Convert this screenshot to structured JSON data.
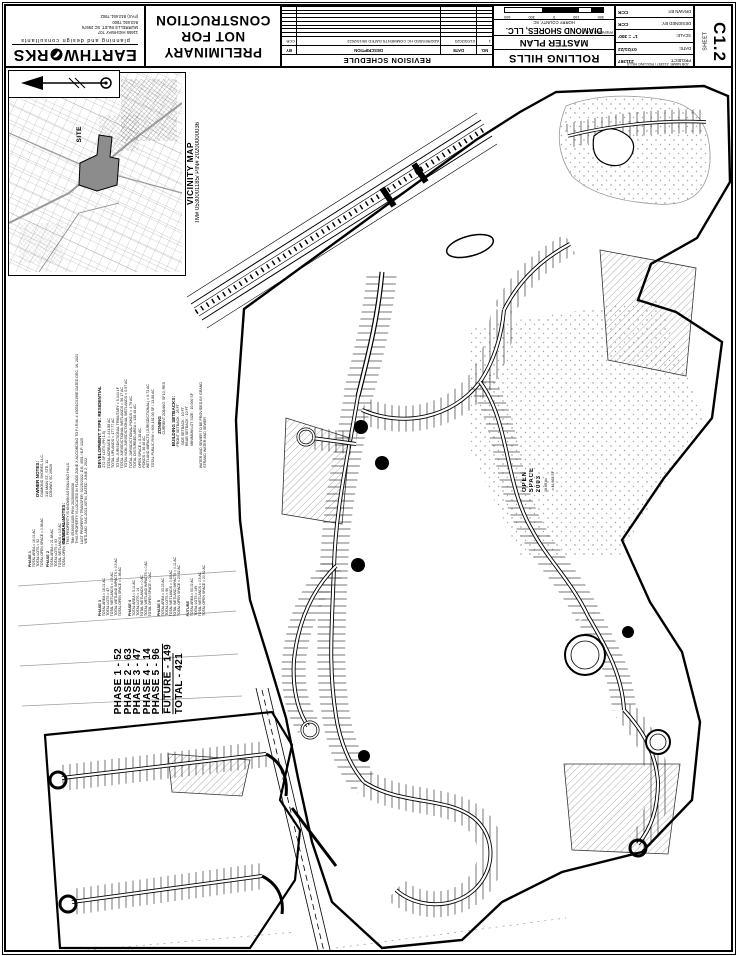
{
  "title_block": {
    "logo": {
      "name_left": "EARTHW",
      "name_right": "RKS",
      "tagline": "planning and design consultants",
      "address1": "11655 HIGHWAY 707",
      "address2": "MURRELLS INLET, SC 29576",
      "phone": "843.651.7900",
      "fax": "(FAX) 843.651.7902"
    },
    "stamp": {
      "line1": "PRELIMINARY",
      "line2": "NOT FOR",
      "line3": "CONSTRUCTION"
    },
    "revision": {
      "title": "REVISION SCHEDULE",
      "headers": [
        "NO.",
        "DATE",
        "DESCRIPTION",
        "BY"
      ],
      "row1": {
        "no": "1",
        "date": "01/03/2023",
        "description": "ADDRESSED HC COMMENTS DATED 09/19/2022",
        "by": "CCR"
      }
    },
    "project": {
      "name": "ROLLING HILLS",
      "sheet_title": "MASTER PLAN",
      "prepared_for": "PREPARED FOR:",
      "client": "DIAMOND SHORES, LLC.",
      "county": "HORRY COUNTY, SC",
      "scale_labels": [
        "300",
        "150",
        "0",
        "300",
        "600"
      ]
    },
    "info": {
      "drawn_by_label": "DRAWN BY:",
      "drawn_by": "CCR",
      "designed_by_label": "DESIGNED BY:",
      "designed_by": "CCR",
      "scale_label": "SCALE:",
      "scale": "1\" = 300'",
      "date_label": "DATE:",
      "date": "07/21/22",
      "project_label": "PROJECT:",
      "project_no": "211397",
      "job_name": "JOB NAME: 211397 / ROLLING HILLS"
    },
    "sheet_box": {
      "label": "SHEET",
      "number": "C1.2"
    }
  },
  "vicinity": {
    "title": "VICINITY MAP",
    "subtitle": "TM# 0530001185/ PIN# 20200000036",
    "site_label": "SITE"
  },
  "plan": {
    "phase_summary": [
      "PHASE 1 - 52",
      "PHASE 2 - 63",
      "PHASE 3 - 47",
      "PHASE 4 - 14",
      "PHASE 5 - 96",
      "FUTURE - 149",
      "TOTAL   - 421"
    ],
    "owner_notes": {
      "heading": "OWNER NOTES:",
      "lines": [
        "DIAMOND SHORES, LLC.",
        "310 MAIN ST., STE. 11",
        "CONWAY, SC 29526"
      ]
    },
    "general_notes": {
      "heading": "GENERAL NOTES:",
      "lines": [
        "THIS PROPERTY IS KNOWN AS ROLLING HILLS.",
        "TM# 0530001185/ PIN# 20200000036",
        "THIS PROPERTY IS LOCATED IN FLOOD ZONE X ACCORDING TO F.I.R.M. # 45051C0195E DATED DEC. 16, 2021",
        "LAST PROPERTY TRANSFER: 02/25/2022, D.B. 4551 / B.P. 1325",
        "WETLAND: SAC-2021-00764, DATED: JUNE 2, 2022"
      ]
    },
    "development_notes": {
      "heading": "DEVELOPMENT TYPE: RESIDENTIAL",
      "lines": [
        "272 SF LOTS (PH 1-5)",
        "TOTAL ACREAGE = 241.88 AC",
        "TOTAL UPLANDS = 177.77 AC",
        "TOTAL JURISDICTIONAL TRIBUTARY = 5,344 LF",
        "TOTAL JURISDICTIONAL WETLANDS = 56.17 AC",
        "TOTAL NON-JURISDICTIONAL WETLANDS = 0.97 AC",
        "TOTAL JURISDICTIONAL PONDS = 4.79 AC",
        "TOTAL DISTURBED AREA = 138.48 AC",
        "OPEN SPACE = 8.38 AC",
        "PONDS = 36.46 AC",
        "WETLAND IMPACTS (JURISDICTIONAL) = 0.73 AC",
        "TOTAL PUBLIC R/W = 604,181.00 SF / 13.88 AC"
      ]
    },
    "zoning_notes": {
      "heading": "ZONING",
      "lines": [
        "CURRENT ZONING: SF10, RES"
      ]
    },
    "setback_notes": {
      "heading": "BUILDING SETBACKS:",
      "lines": [
        "FRONT SETBACK : 25 FT",
        "SIDE SETBACK : 10 FT",
        "REAR SETBACK : 10 FT",
        "MINIMUM LOT SIZE : 10,000 SF"
      ]
    },
    "utility_notes": {
      "heading": "WATER AND SEWER TO BE PROVIDED BY GRAND",
      "lines": [
        "STRAND WATER AND SEWER"
      ]
    },
    "phases_breakdown": {
      "phase1": [
        "PHASE 1",
        "TOTAL AREA = 16.01 AC",
        "TOTAL LOTS = 52",
        "TOTAL OPEN SPACE = 0.98 AC"
      ],
      "phase2": [
        "PHASE 2",
        "TOTAL AREA = 21.88 AC",
        "TOTAL LOTS = 63",
        "TOTAL WETLANDS = 0.5 AC",
        "TOTAL OPEN SPACE = 4.51 AC"
      ],
      "phase3": [
        "PHASE 3",
        "TOTAL AREA = 18.01 AC",
        "TOTAL LOTS = 47",
        "TOTAL WETLANDS = 0.5 AC",
        "TOTAL WETLAND IMPACTS = 0.5 AC",
        "TOTAL OPEN SPACE = 1.98 AC"
      ],
      "phase4": [
        "PHASE 4",
        "TOTAL AREA = 5.11 AC",
        "TOTAL LOTS = 14",
        "TOTAL WETLANDS = 0 AC",
        "TOTAL WETLAND IMPACTS = 0 AC",
        "TOTAL OPEN SPACE = 0 AC"
      ],
      "phase5": [
        "PHASE 5",
        "TOTAL AREA = 33.03 AC",
        "TOTAL LOTS = 96",
        "TOTAL WETLANDS = 0.63 AC",
        "TOTAL WETLAND IMPACTS = 0.11 AC",
        "TOTAL OPEN SPACE = 20.62 AC"
      ],
      "future": [
        "FUTURE",
        "TOTAL AREA = 53.02 AC",
        "TOTAL LOTS = 149",
        "TOTAL WETLANDS = 0.5 AC",
        "TOTAL OPEN SPACE = 20.52 AC"
      ]
    },
    "open_space_label": [
      "OPEN",
      "SPACE",
      "2003"
    ],
    "open_space_area": [
      "16.65 Ac",
      "±14,662 SF"
    ]
  }
}
